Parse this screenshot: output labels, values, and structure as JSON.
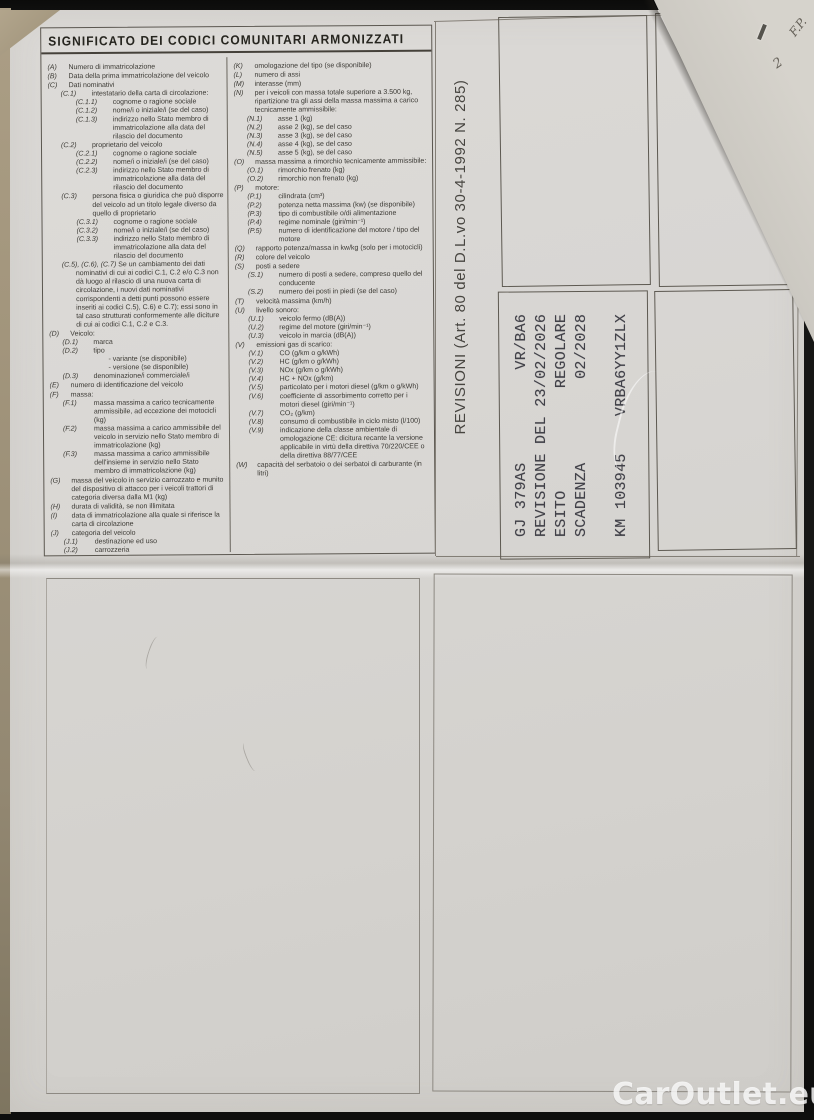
{
  "title": "SIGNIFICATO DEI CODICI COMUNITARI ARMONIZZATI",
  "colors": {
    "paper": "#d7d5d2",
    "ink": "#3a3833",
    "stamp_ink": "#31313a",
    "background": "#141413",
    "watermark": "#fcfcfc"
  },
  "codes": {
    "left": [
      {
        "code": "(A)",
        "text": "Numero di immatricolazione",
        "level": 0
      },
      {
        "code": "(B)",
        "text": "Data della prima immatricolazione del veicolo",
        "level": 0
      },
      {
        "code": "(C)",
        "text": "Dati nominativi",
        "level": 0
      },
      {
        "code": "(C.1)",
        "text": "intestatario della carta di circolazione:",
        "level": 1
      },
      {
        "code": "(C.1.1)",
        "text": "cognome o ragione sociale",
        "level": 2
      },
      {
        "code": "(C.1.2)",
        "text": "nome/i o iniziale/i (se del caso)",
        "level": 2
      },
      {
        "code": "(C.1.3)",
        "text": "indirizzo nello Stato membro di immatricolazione alla data del rilascio del documento",
        "level": 2
      },
      {
        "code": "(C.2)",
        "text": "proprietario del veicolo",
        "level": 1
      },
      {
        "code": "(C.2.1)",
        "text": "cognome o ragione sociale",
        "level": 2
      },
      {
        "code": "(C.2.2)",
        "text": "nome/i o iniziale/i (se del caso)",
        "level": 2
      },
      {
        "code": "(C.2.3)",
        "text": "indirizzo nello Stato membro di immatricolazione alla data del rilascio del documento",
        "level": 2
      },
      {
        "code": "(C.3)",
        "text": "persona fisica o giuridica che può disporre del veicolo ad un titolo legale diverso da quello di proprietario",
        "level": 1
      },
      {
        "code": "(C.3.1)",
        "text": "cognome o ragione sociale",
        "level": 2
      },
      {
        "code": "(C.3.2)",
        "text": "nome/i o iniziale/i (se del caso)",
        "level": 2
      },
      {
        "code": "(C.3.3)",
        "text": "indirizzo nello Stato membro di immatricolazione alla data del rilascio del documento",
        "level": 2
      },
      {
        "code": "(C.5), (C.6), (C.7)",
        "text": "Se un cambiamento dei dati nominativi di cui ai codici C.1, C.2 e/o C.3 non dà luogo al rilascio di una nuova carta di circolazione, i nuovi dati nominativi corrispondenti a detti punti possono essere inseriti ai codici C.5), C.6) e C.7); essi sono in tal caso strutturati conformemente alle diciture di cui ai codici C.1, C.2 e C.3.",
        "level": 1,
        "flow": true
      },
      {
        "code": "(D)",
        "text": "Veicolo:",
        "level": 0
      },
      {
        "code": "(D.1)",
        "text": "marca",
        "level": 1
      },
      {
        "code": "(D.2)",
        "text": "tipo",
        "level": 1
      },
      {
        "code": "",
        "text": "- variante (se disponibile)",
        "level": 2,
        "plain": true
      },
      {
        "code": "",
        "text": "- versione (se disponibile)",
        "level": 2,
        "plain": true
      },
      {
        "code": "(D.3)",
        "text": "denominazione/i commerciale/i",
        "level": 1
      },
      {
        "code": "(E)",
        "text": "numero di identificazione del veicolo",
        "level": 0
      },
      {
        "code": "(F)",
        "text": "massa:",
        "level": 0
      },
      {
        "code": "(F.1)",
        "text": "massa massima a carico tecnicamente ammissibile, ad eccezione dei motocicli (kg)",
        "level": 1
      },
      {
        "code": "(F.2)",
        "text": "massa massima a carico ammissibile del veicolo in servizio nello Stato membro di immatricolazione (kg)",
        "level": 1
      },
      {
        "code": "(F.3)",
        "text": "massa massima a carico ammissibile dell'insieme in servizio nello Stato membro di immatricolazione (kg)",
        "level": 1
      },
      {
        "code": "(G)",
        "text": "massa del veicolo in servizio carrozzato e munito del dispositivo di attacco per i veicoli trattori di categoria diversa dalla M1 (kg)",
        "level": 0
      },
      {
        "code": "(H)",
        "text": "durata di validità, se non illimitata",
        "level": 0
      },
      {
        "code": "(I)",
        "text": "data di immatricolazione alla quale si riferisce la carta di circolazione",
        "level": 0
      },
      {
        "code": "(J)",
        "text": "categoria del veicolo",
        "level": 0
      },
      {
        "code": "(J.1)",
        "text": "destinazione ed uso",
        "level": 1
      },
      {
        "code": "(J.2)",
        "text": "carrozzeria",
        "level": 1
      }
    ],
    "right": [
      {
        "code": "(K)",
        "text": "omologazione del tipo (se disponibile)",
        "level": 0
      },
      {
        "code": "(L)",
        "text": "numero di assi",
        "level": 0
      },
      {
        "code": "(M)",
        "text": "interasse (mm)",
        "level": 0
      },
      {
        "code": "(N)",
        "text": "per i veicoli con massa totale superiore a 3.500 kg, ripartizione tra gli assi della massa massima a carico tecnicamente ammissibile:",
        "level": 0
      },
      {
        "code": "(N.1)",
        "text": "asse 1 (kg)",
        "level": 1
      },
      {
        "code": "(N.2)",
        "text": "asse 2 (kg), se del caso",
        "level": 1
      },
      {
        "code": "(N.3)",
        "text": "asse 3 (kg), se del caso",
        "level": 1
      },
      {
        "code": "(N.4)",
        "text": "asse 4 (kg), se del caso",
        "level": 1
      },
      {
        "code": "(N.5)",
        "text": "asse 5 (kg), se del caso",
        "level": 1
      },
      {
        "code": "(O)",
        "text": "massa massima a rimorchio tecnicamente ammissibile:",
        "level": 0
      },
      {
        "code": "(O.1)",
        "text": "rimorchio frenato (kg)",
        "level": 1
      },
      {
        "code": "(O.2)",
        "text": "rimorchio non frenato (kg)",
        "level": 1
      },
      {
        "code": "(P)",
        "text": "motore:",
        "level": 0
      },
      {
        "code": "(P.1)",
        "text": "cilindrata (cm³)",
        "level": 1
      },
      {
        "code": "(P.2)",
        "text": "potenza netta massima (kw) (se disponibile)",
        "level": 1
      },
      {
        "code": "(P.3)",
        "text": "tipo di combustibile o/di alimentazione",
        "level": 1
      },
      {
        "code": "(P.4)",
        "text": "regime nominale (giri/min⁻¹)",
        "level": 1
      },
      {
        "code": "(P.5)",
        "text": "numero di identificazione del motore / tipo del motore",
        "level": 1
      },
      {
        "code": "(Q)",
        "text": "rapporto potenza/massa in kw/kg (solo per i motocicli)",
        "level": 0
      },
      {
        "code": "(R)",
        "text": "colore del veicolo",
        "level": 0
      },
      {
        "code": "(S)",
        "text": "posti a sedere",
        "level": 0
      },
      {
        "code": "(S.1)",
        "text": "numero di posti a sedere, compreso quello del conducente",
        "level": 1
      },
      {
        "code": "(S.2)",
        "text": "numero dei posti in piedi (se del caso)",
        "level": 1
      },
      {
        "code": "(T)",
        "text": "velocità massima (km/h)",
        "level": 0
      },
      {
        "code": "(U)",
        "text": "livello sonoro:",
        "level": 0
      },
      {
        "code": "(U.1)",
        "text": "veicolo fermo (dB(A))",
        "level": 1
      },
      {
        "code": "(U.2)",
        "text": "regime del motore (giri/min⁻¹)",
        "level": 1
      },
      {
        "code": "(U.3)",
        "text": "veicolo in marcia (dB(A))",
        "level": 1
      },
      {
        "code": "(V)",
        "text": "emissioni gas di scarico:",
        "level": 0
      },
      {
        "code": "(V.1)",
        "text": "CO (g/km o g/kWh)",
        "level": 1
      },
      {
        "code": "(V.2)",
        "text": "HC (g/km o g/kWh)",
        "level": 1
      },
      {
        "code": "(V.3)",
        "text": "NOx (g/km o g/kWh)",
        "level": 1
      },
      {
        "code": "(V.4)",
        "text": "HC + NOx (g/km)",
        "level": 1
      },
      {
        "code": "(V.5)",
        "text": "particolato per i motori diesel (g/km o g/kWh)",
        "level": 1
      },
      {
        "code": "(V.6)",
        "text": "coefficiente di assorbimento corretto per i motori diesel (giri/min⁻¹)",
        "level": 1
      },
      {
        "code": "(V.7)",
        "text": "CO₂ (g/km)",
        "level": 1
      },
      {
        "code": "(V.8)",
        "text": "consumo di combustibile in ciclo misto (l/100)",
        "level": 1
      },
      {
        "code": "(V.9)",
        "text": "indicazione della classe ambientale di omologazione CE: dicitura recante la versione applicabile in virtù della direttiva 70/220/CEE o della direttiva 88/77/CEE",
        "level": 1
      },
      {
        "code": "(W)",
        "text": "capacità del serbatoio o dei serbatoi di carburante (in litri)",
        "level": 0
      }
    ]
  },
  "revisioni": {
    "label": "REVISIONI (Art. 80 del D.L.vo 30-4-1992 N. 285)",
    "stamp_lines": [
      "GJ 379AS          VR/BA6",
      "REVISIONE DEL 23/02/2026",
      "ESITO           REGOLARE",
      "SCADENZA         02/2028",
      "",
      "KM 103945    VRBA6YY1ZLX"
    ]
  },
  "fold_notes": {
    "note1": "F.P.",
    "note2": "2"
  },
  "watermark": "CarOutlet.eu"
}
